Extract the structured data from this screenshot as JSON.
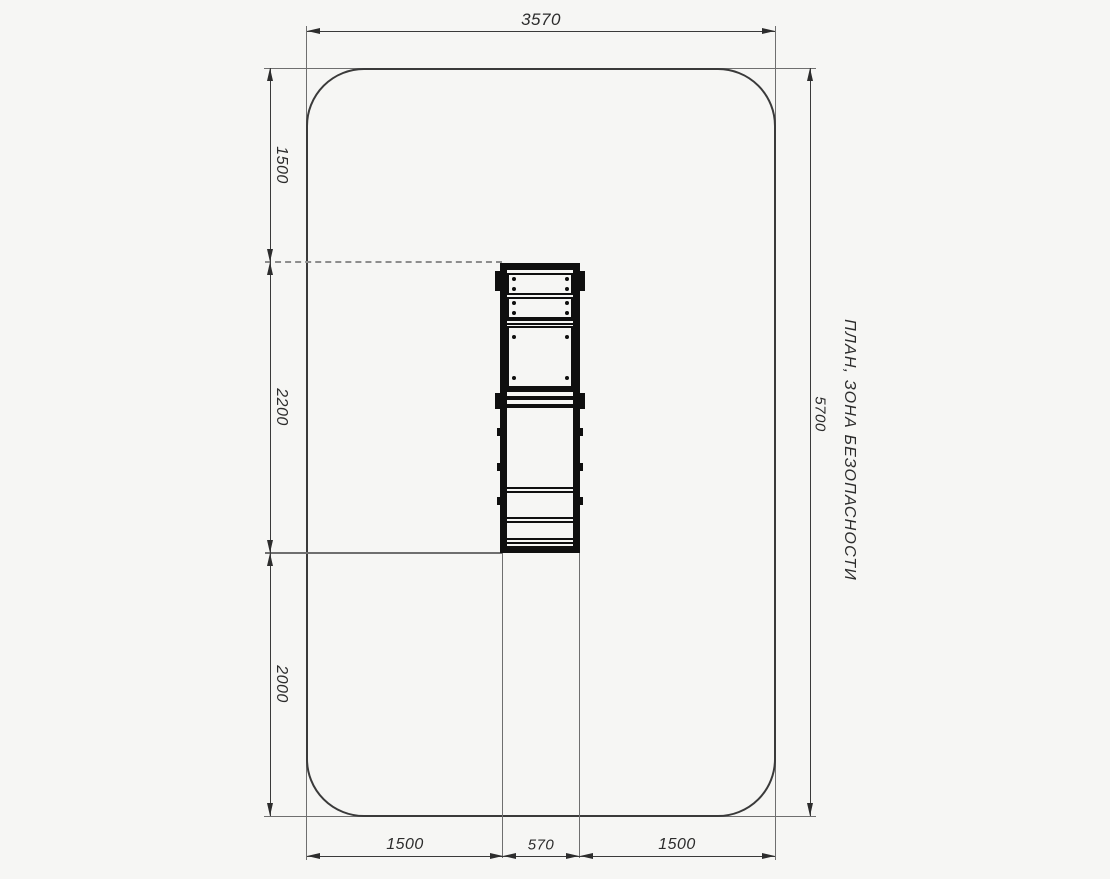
{
  "drawing": {
    "title": "ПЛАН, ЗОНА БЕЗОПАСНОСТИ",
    "dims": {
      "top": "3570",
      "right": "5700",
      "left": [
        "1500",
        "2200",
        "2000"
      ],
      "bottom": [
        "1500",
        "570",
        "1500"
      ]
    },
    "colors": {
      "background": "#f6f6f4",
      "outline": "#3a3a3a",
      "thin_line": "#6f6f6f",
      "equipment": "#0f0f0f",
      "text": "#2c2c2c",
      "dashed_line": "#8d8d8d"
    }
  }
}
